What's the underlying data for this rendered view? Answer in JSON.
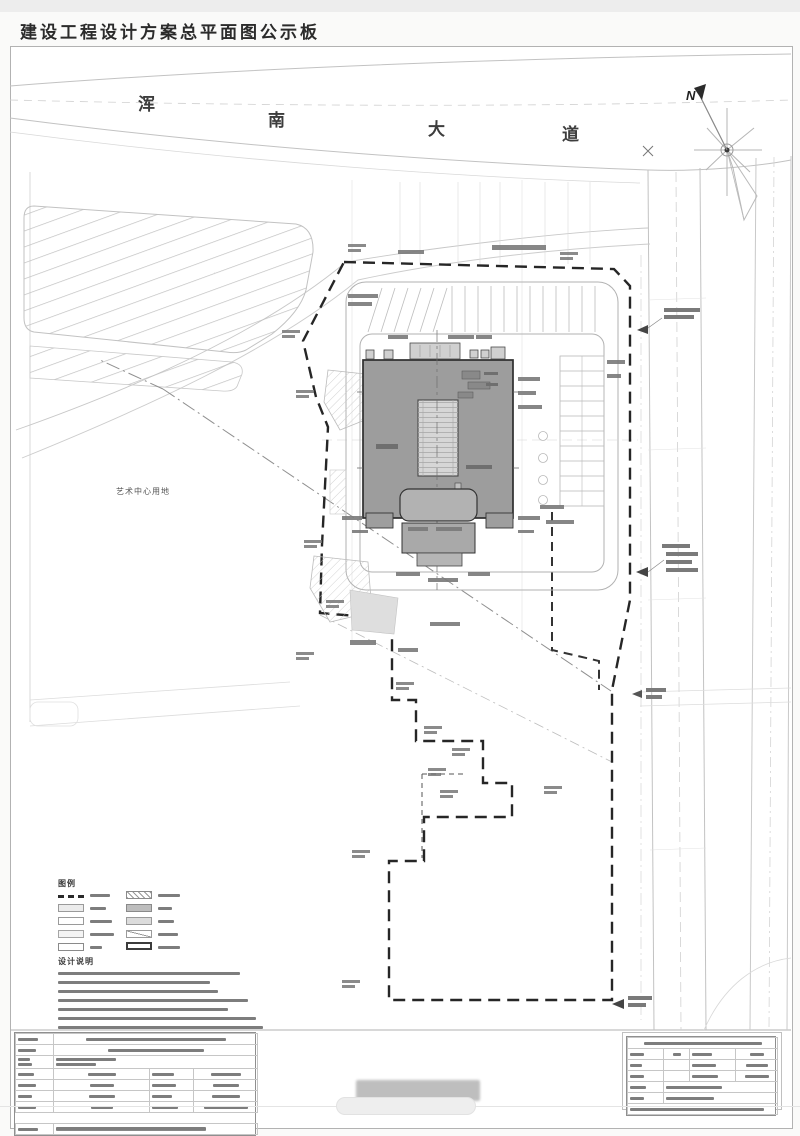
{
  "title": "建设工程设计方案总平面图公示板",
  "plan": {
    "road_name": "浑南大道",
    "road_chars": [
      "浑",
      "南",
      "大",
      "道"
    ],
    "north_label": "N",
    "reserved_site_label": "艺术中心用地",
    "legend_heading": "图例",
    "notes_heading": "设计说明",
    "colors": {
      "building_fill": "#9d9d9d",
      "boundary_line": "#262626",
      "road_line": "#c2c2c2",
      "hatch_line": "#c0c0c0"
    }
  }
}
